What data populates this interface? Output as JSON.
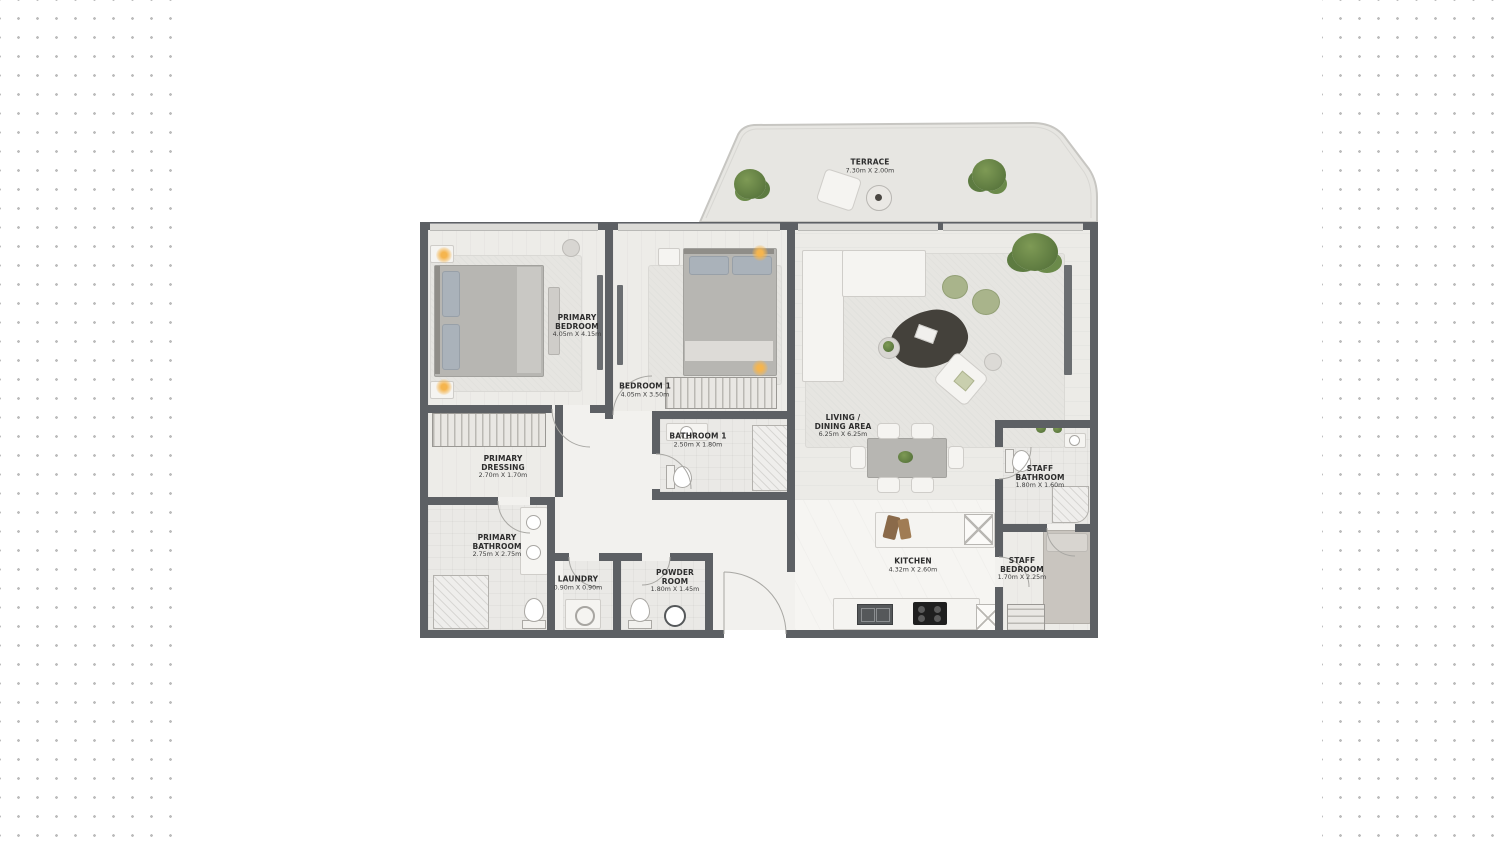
{
  "page": {
    "background_color": "#ffffff",
    "dot_color": "#bdbdbd"
  },
  "floor_plan": {
    "wall_color": "#5d6064",
    "floor_color": "#f2f1ee",
    "accent_plant_green": "#5f7d43",
    "accent_pouf_green": "#a9b48b",
    "lamp_glow_color": "#f5b54e",
    "rooms": [
      {
        "id": "terrace",
        "name": "TERRACE",
        "dims": "7.30m X 2.00m"
      },
      {
        "id": "primary-bedroom",
        "name": "PRIMARY BEDROOM",
        "dims": "4.05m X 4.15m"
      },
      {
        "id": "bedroom-1",
        "name": "BEDROOM 1",
        "dims": "4.05m X 3.50m"
      },
      {
        "id": "living-dining",
        "name": "LIVING / DINING AREA",
        "dims": "6.25m X 6.25m"
      },
      {
        "id": "primary-dressing",
        "name": "PRIMARY DRESSING",
        "dims": "2.70m X 1.70m"
      },
      {
        "id": "bathroom-1",
        "name": "BATHROOM 1",
        "dims": "2.50m X 1.80m"
      },
      {
        "id": "primary-bathroom",
        "name": "PRIMARY BATHROOM",
        "dims": "2.75m X 2.75m"
      },
      {
        "id": "laundry",
        "name": "LAUNDRY",
        "dims": "0.90m X 0.90m"
      },
      {
        "id": "powder-room",
        "name": "POWDER ROOM",
        "dims": "1.80m X 1.45m"
      },
      {
        "id": "kitchen",
        "name": "KITCHEN",
        "dims": "4.32m X 2.60m"
      },
      {
        "id": "staff-bathroom",
        "name": "STAFF BATHROOM",
        "dims": "1.80m X 1.60m"
      },
      {
        "id": "staff-bedroom",
        "name": "STAFF BEDROOM",
        "dims": "1.70m X 2.25m"
      }
    ]
  }
}
